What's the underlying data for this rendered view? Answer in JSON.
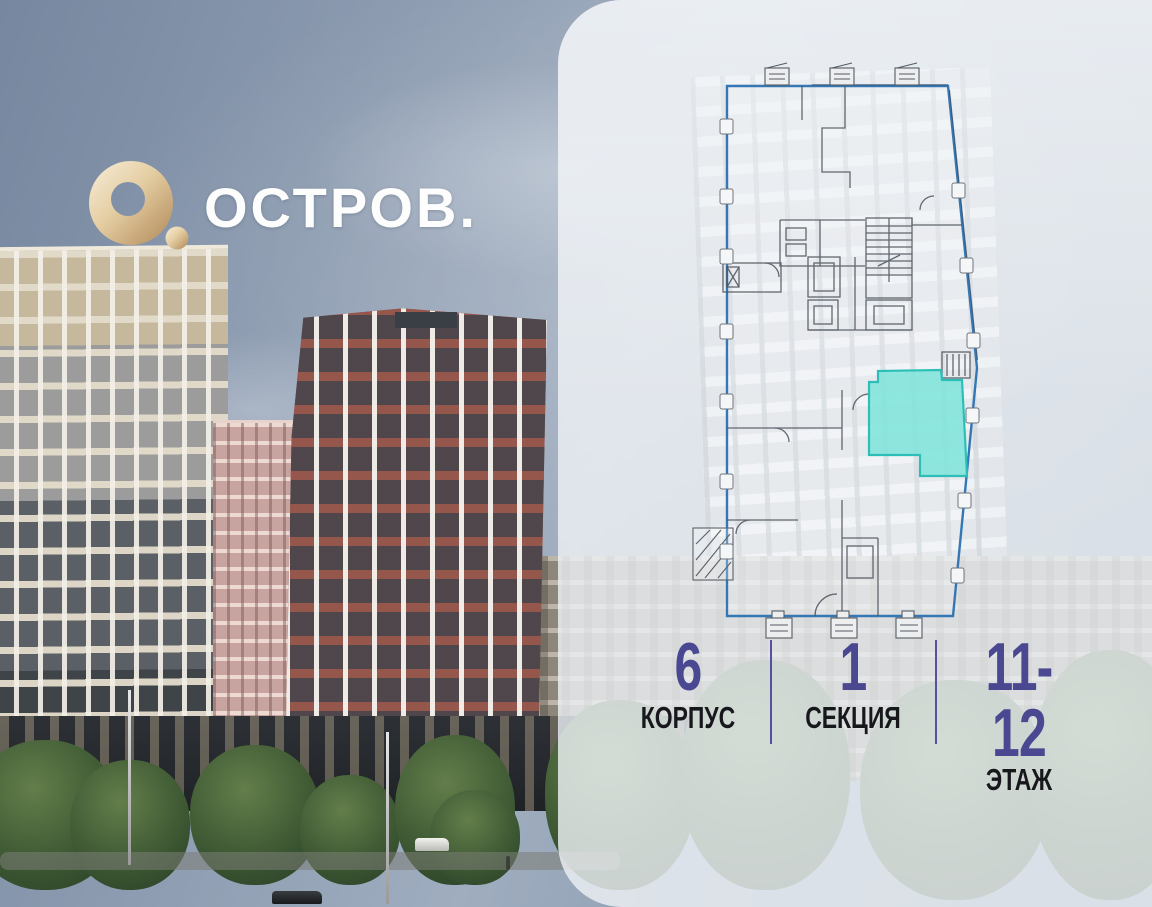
{
  "brand": {
    "logo_text": "ОСТРОВ.",
    "logo_icon": "gold-ring-with-dot",
    "logo_gold_color": "#d7ba8b",
    "text_color": "#fdfdfd"
  },
  "panel": {
    "background_color": "#edf0f4",
    "floor_plan": {
      "outline_color": "#3577b4",
      "wall_color": "#4e555d",
      "highlighted_unit": {
        "fill": "#7de4db",
        "stroke": "#2dbfb7",
        "building": "6",
        "section": "1",
        "floors": "11-12"
      }
    },
    "stats": {
      "value_color": "#4a4891",
      "label_color": "#17181c",
      "divider_color": "#55519f",
      "items": [
        {
          "value": "6",
          "label": "КОРПУС"
        },
        {
          "value": "1",
          "label": "СЕКЦИЯ"
        },
        {
          "value": "11-12",
          "label": "ЭТАЖ"
        }
      ]
    }
  }
}
